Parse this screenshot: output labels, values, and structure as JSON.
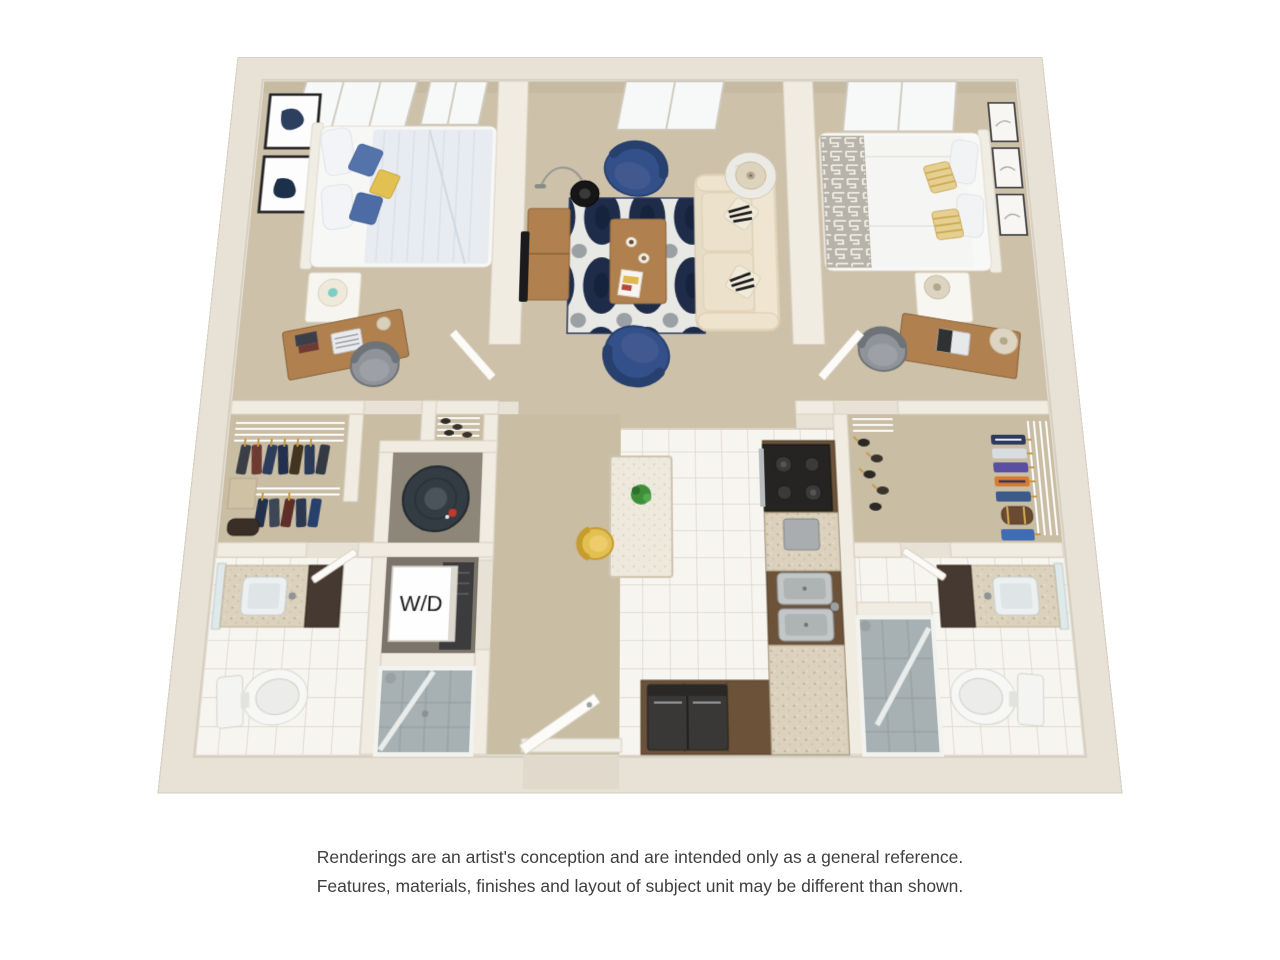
{
  "plan": {
    "wd_label": "W/D"
  },
  "disclaimer": {
    "line1": "Renderings are an artist's conception and are intended only as a general reference.",
    "line2": "Features, materials, finishes and layout of subject unit may be different than shown."
  },
  "palette": {
    "background": "#ffffff",
    "wall": "#e7e1d6",
    "wall_inner": "#f1ece2",
    "carpet": "#cdc1a9",
    "tile": "#f7f5f0",
    "rug_navy": "#1f2c49",
    "rug_white": "#e8e9e5",
    "sofa_cream": "#e7dcc6",
    "chair_blue": "#34508a",
    "accent_yellow": "#e2c052",
    "wood": "#b0804e",
    "cabinet_brown": "#6b5238",
    "appliance_black": "#262422",
    "steel_gray": "#9aa0a3",
    "shower_glass": "#a7b0b3",
    "text_dark": "#3f3f3f"
  }
}
